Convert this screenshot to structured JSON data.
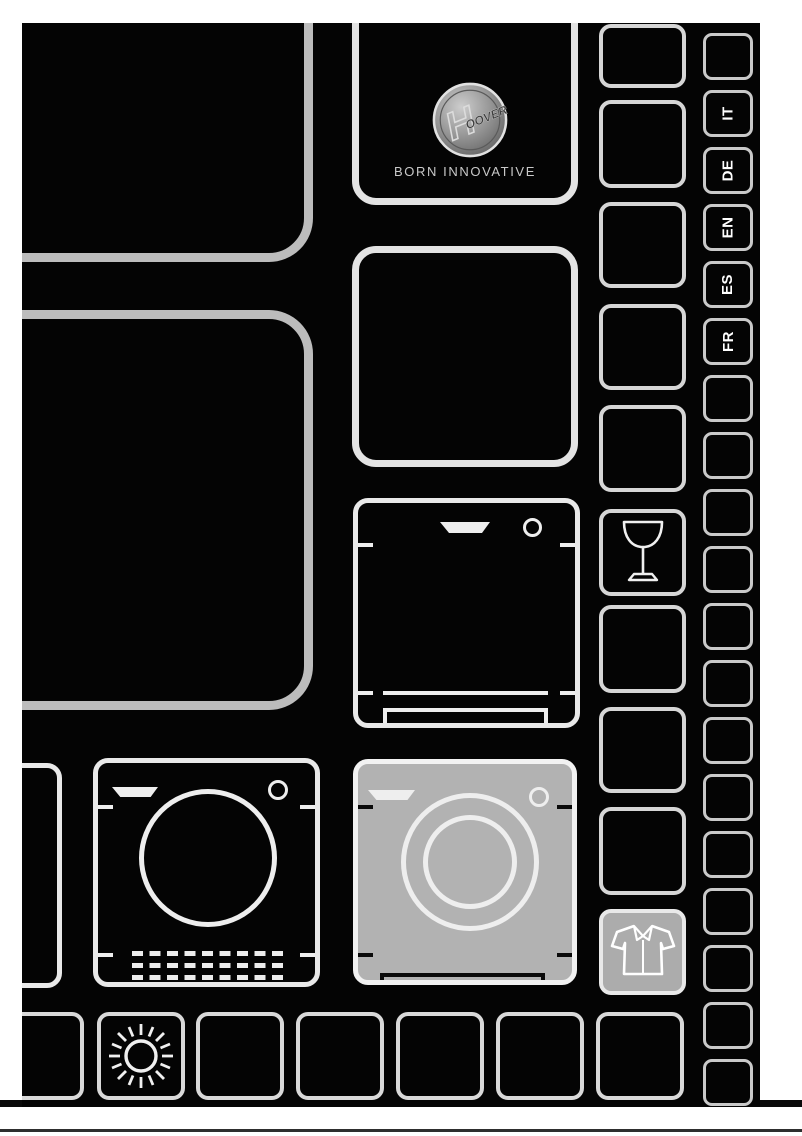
{
  "document": {
    "kind": "appliance-user-manual-cover"
  },
  "brand": {
    "logo_h": "H",
    "logo_rest": "OOVER",
    "tagline": "BORN INNOVATIVE"
  },
  "languages": [
    "IT",
    "DE",
    "EN",
    "ES",
    "FR"
  ],
  "colors": {
    "cover_background": "#040404",
    "page_background": "#ffffff",
    "big_panel_stroke": "#bcbcbc",
    "light_stroke": "#e9e9e9",
    "highlight_gray": "#b2b2b2",
    "highlight_gray_cell": "#acacac",
    "logo_metal": "#9a9a9a",
    "separator_line": "#2e2e2e"
  },
  "icons": {
    "appliances": [
      "dishwasher-icon",
      "tumble-dryer-icon",
      "washing-machine-icon"
    ],
    "symbols": [
      "wine-glass-icon",
      "shirt-icon",
      "sun-icon"
    ],
    "logo": "hoover-logo"
  },
  "right_medium_column": {
    "cells": [
      {
        "icon": null
      },
      {
        "icon": null
      },
      {
        "icon": null
      },
      {
        "icon": null
      },
      {
        "icon": null
      },
      {
        "icon": "wine-glass"
      },
      {
        "icon": null
      },
      {
        "icon": null
      },
      {
        "icon": null
      },
      {
        "icon": "shirt",
        "highlighted": true
      }
    ]
  },
  "right_small_column": {
    "cells": [
      {
        "label": ""
      },
      {
        "label": "IT"
      },
      {
        "label": "DE"
      },
      {
        "label": "EN"
      },
      {
        "label": "ES"
      },
      {
        "label": "FR"
      },
      {
        "label": ""
      },
      {
        "label": ""
      },
      {
        "label": ""
      },
      {
        "label": ""
      },
      {
        "label": ""
      },
      {
        "label": ""
      },
      {
        "label": ""
      },
      {
        "label": ""
      },
      {
        "label": ""
      },
      {
        "label": ""
      },
      {
        "label": ""
      },
      {
        "label": ""
      },
      {
        "label": ""
      }
    ]
  },
  "bottom_row": {
    "cells": [
      {
        "partial": true,
        "icon": null
      },
      {
        "icon": "sun"
      },
      {
        "icon": null
      },
      {
        "icon": null
      },
      {
        "icon": null
      },
      {
        "icon": null
      },
      {
        "icon": null
      }
    ]
  }
}
